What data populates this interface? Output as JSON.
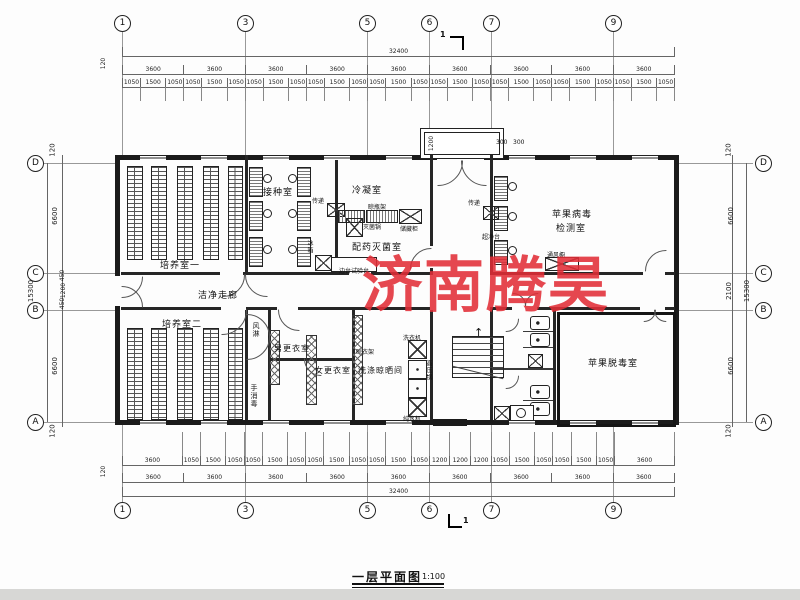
{
  "title_block": {
    "title": "一层平面图",
    "scale": "1:100"
  },
  "watermark": {
    "text": "济南腾昊",
    "color": "rgba(225,45,55,0.88)"
  },
  "grid": {
    "top_labels": [
      "1",
      "3",
      "5",
      "6",
      "7",
      "9"
    ],
    "bottom_labels": [
      "1",
      "3",
      "5",
      "6",
      "7",
      "9"
    ],
    "left_labels": [
      "D",
      "C",
      "B",
      "A"
    ],
    "right_labels": [
      "D",
      "C",
      "B",
      "A"
    ],
    "section_mark": "1"
  },
  "dimensions": {
    "top": {
      "total": "32400",
      "edge": "120",
      "bays": [
        "3600",
        "3600",
        "3600",
        "3600",
        "3600",
        "3600",
        "3600",
        "3600",
        "3600"
      ],
      "detail": [
        "1050",
        "1500",
        "1050",
        "1050",
        "1500",
        "1050",
        "1050",
        "1500",
        "1050",
        "1050",
        "1500",
        "1050",
        "1050",
        "1500",
        "1050",
        "1050",
        "1500",
        "1050",
        "1050",
        "1500",
        "1050",
        "1050",
        "1500",
        "1050",
        "1050",
        "1500",
        "1050"
      ]
    },
    "bottom": {
      "total": "32400",
      "edge": "120",
      "bays": [
        "3600",
        "3600",
        "3600",
        "3600",
        "3600",
        "3600",
        "3600",
        "3600",
        "3600"
      ],
      "detail": [
        "3600",
        "1050",
        "1500",
        "1050",
        "1050",
        "1500",
        "1050",
        "1050",
        "1500",
        "1050",
        "1050",
        "1500",
        "1050",
        "1200",
        "1200",
        "1200",
        "1050",
        "1500",
        "1050",
        "1050",
        "1500",
        "1050",
        "3600"
      ]
    },
    "left": {
      "total": "15300",
      "segments": [
        "120",
        "6600",
        "450",
        "1200",
        "450",
        "6600",
        "120"
      ]
    },
    "right": {
      "total": "15300",
      "segments": [
        "120",
        "6600",
        "2100",
        "6600",
        "120"
      ]
    },
    "porch": {
      "depth": "1200",
      "left": "300",
      "right": "300"
    }
  },
  "rooms": {
    "culture1": "培养室一",
    "inoculation": "接种室",
    "condensation": "冷凝室",
    "dispensing": "配药灭菌室",
    "virus_detection_l1": "苹果病毒",
    "virus_detection_l2": "检测室",
    "corridor": "洁净走廊",
    "culture2": "培养室二",
    "air_shower": "风淋",
    "hand_disinfect": "手消毒",
    "men_changing": "男更衣室",
    "women_changing": "女更衣室",
    "washing": "洗涤晾晒间",
    "virus_free": "苹果脱毒室"
  },
  "equipment": {
    "pass_window": "传递",
    "fridge": "冰箱",
    "sterilizer": "灭菌锅",
    "bottle_rack": "晾瓶架",
    "storage_cabinet": "储藏柜",
    "side_bench": "边台试验台",
    "clean_bench": "超净台",
    "fume_hood": "通风橱",
    "washer": "洗衣机",
    "autoclave": "高压锅",
    "water_purifier": "纯水机",
    "drying_rack": "晾衣架"
  },
  "icons": {
    "stairs_up_arrow": "↑"
  }
}
